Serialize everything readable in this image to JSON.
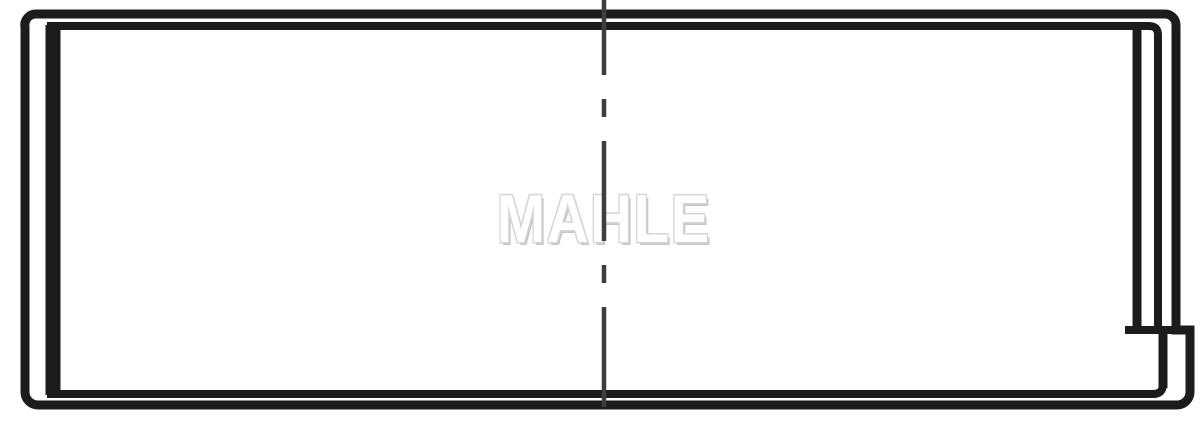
{
  "drawing": {
    "watermark": "MAHLE",
    "colors": {
      "background": "#ffffff",
      "line": "#1c1c1c",
      "centerline": "#3e3e3e",
      "watermark_outline": "#d6d6d6",
      "watermark_shadow": "#c6c6c6"
    }
  }
}
